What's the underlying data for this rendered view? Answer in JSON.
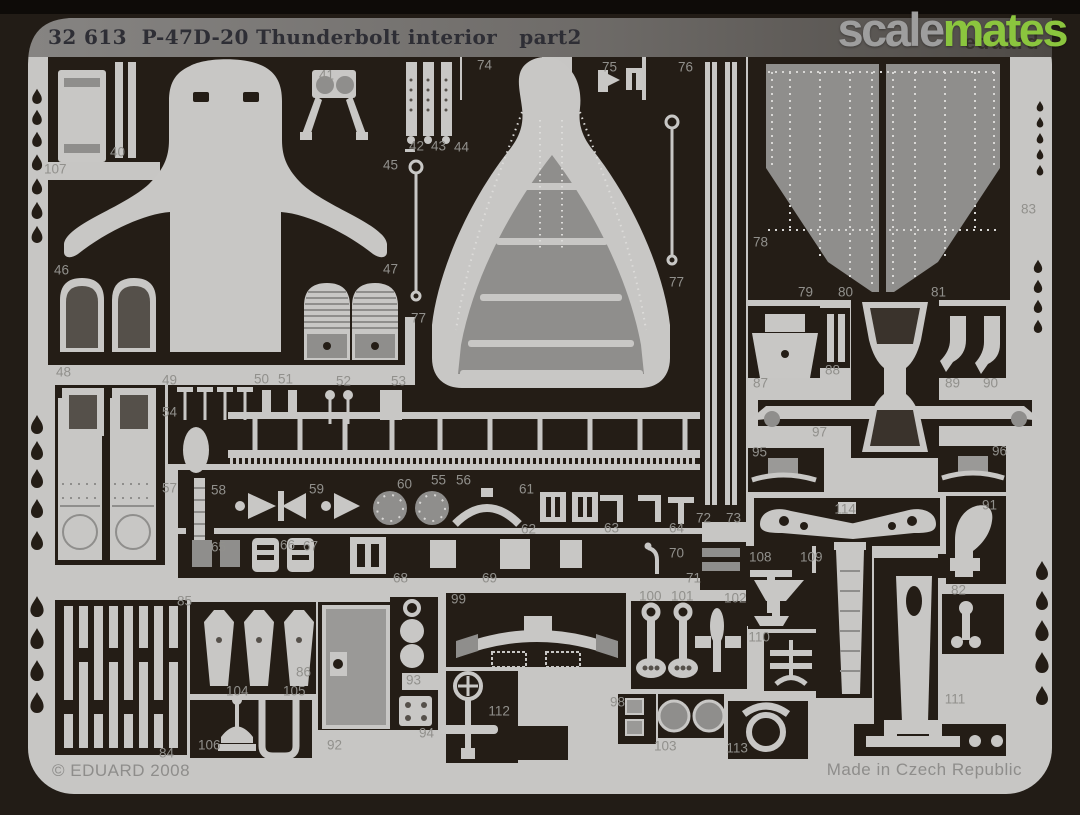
{
  "header": {
    "title": "32 613  P-47D-20 Thunderbolt interior   part2",
    "brand": "eduard"
  },
  "watermark": {
    "scale": "scale",
    "mates": "mates"
  },
  "footer": {
    "copyright": "© EDUARD 2008",
    "made_in": "Made in Czech Republic"
  },
  "colors": {
    "photo_background": "#221c16",
    "fret_metal": "#c7c6c4",
    "cutout_dark": "#241d16",
    "part_medium_gray": "#8f8e8c",
    "label_text": "#91908c",
    "title_text": "#2e2e35",
    "watermark_scale": "#9e9e9e",
    "watermark_mates": "#8bc53e"
  },
  "fret": {
    "description_visible_numbers": "etched part numbers 40 to 114",
    "part_labels": [
      {
        "n": "107",
        "x": 53,
        "y": 169
      },
      {
        "n": "40",
        "x": 116,
        "y": 152
      },
      {
        "n": "41",
        "x": 325,
        "y": 75
      },
      {
        "n": "42",
        "x": 415,
        "y": 146
      },
      {
        "n": "43",
        "x": 437,
        "y": 146
      },
      {
        "n": "44",
        "x": 460,
        "y": 147
      },
      {
        "n": "45",
        "x": 389,
        "y": 165
      },
      {
        "n": "74",
        "x": 483,
        "y": 65
      },
      {
        "n": "75",
        "x": 608,
        "y": 67
      },
      {
        "n": "76",
        "x": 684,
        "y": 67
      },
      {
        "n": "78",
        "x": 759,
        "y": 242
      },
      {
        "n": "83",
        "x": 1027,
        "y": 209
      },
      {
        "n": "79",
        "x": 804,
        "y": 292
      },
      {
        "n": "80",
        "x": 844,
        "y": 292
      },
      {
        "n": "81",
        "x": 937,
        "y": 292
      },
      {
        "n": "46",
        "x": 60,
        "y": 270
      },
      {
        "n": "47",
        "x": 389,
        "y": 269
      },
      {
        "n": "77",
        "x": 417,
        "y": 318
      },
      {
        "n": "77",
        "x": 675,
        "y": 282
      },
      {
        "n": "48",
        "x": 62,
        "y": 372
      },
      {
        "n": "49",
        "x": 168,
        "y": 380
      },
      {
        "n": "50",
        "x": 260,
        "y": 379
      },
      {
        "n": "51",
        "x": 284,
        "y": 379
      },
      {
        "n": "52",
        "x": 342,
        "y": 381
      },
      {
        "n": "53",
        "x": 397,
        "y": 381
      },
      {
        "n": "54",
        "x": 168,
        "y": 412
      },
      {
        "n": "55",
        "x": 437,
        "y": 480
      },
      {
        "n": "56",
        "x": 462,
        "y": 480
      },
      {
        "n": "57",
        "x": 168,
        "y": 488
      },
      {
        "n": "58",
        "x": 217,
        "y": 490
      },
      {
        "n": "59",
        "x": 315,
        "y": 489
      },
      {
        "n": "60",
        "x": 403,
        "y": 484
      },
      {
        "n": "61",
        "x": 525,
        "y": 489
      },
      {
        "n": "62",
        "x": 527,
        "y": 529
      },
      {
        "n": "63",
        "x": 610,
        "y": 528
      },
      {
        "n": "64",
        "x": 675,
        "y": 528
      },
      {
        "n": "65",
        "x": 217,
        "y": 547
      },
      {
        "n": "66",
        "x": 286,
        "y": 545
      },
      {
        "n": "67",
        "x": 309,
        "y": 546
      },
      {
        "n": "68",
        "x": 399,
        "y": 578
      },
      {
        "n": "69",
        "x": 488,
        "y": 578
      },
      {
        "n": "70",
        "x": 675,
        "y": 553
      },
      {
        "n": "71",
        "x": 692,
        "y": 578
      },
      {
        "n": "72",
        "x": 702,
        "y": 518
      },
      {
        "n": "73",
        "x": 732,
        "y": 518
      },
      {
        "n": "87",
        "x": 759,
        "y": 383
      },
      {
        "n": "88",
        "x": 831,
        "y": 370
      },
      {
        "n": "89",
        "x": 951,
        "y": 383
      },
      {
        "n": "90",
        "x": 989,
        "y": 383
      },
      {
        "n": "97",
        "x": 818,
        "y": 432
      },
      {
        "n": "95",
        "x": 758,
        "y": 452
      },
      {
        "n": "96",
        "x": 998,
        "y": 451
      },
      {
        "n": "114",
        "x": 843,
        "y": 509
      },
      {
        "n": "91",
        "x": 988,
        "y": 505
      },
      {
        "n": "108",
        "x": 758,
        "y": 557
      },
      {
        "n": "109",
        "x": 809,
        "y": 557
      },
      {
        "n": "82",
        "x": 957,
        "y": 590
      },
      {
        "n": "85",
        "x": 183,
        "y": 601
      },
      {
        "n": "86",
        "x": 302,
        "y": 672
      },
      {
        "n": "104",
        "x": 235,
        "y": 691
      },
      {
        "n": "105",
        "x": 292,
        "y": 691
      },
      {
        "n": "106",
        "x": 207,
        "y": 745
      },
      {
        "n": "84",
        "x": 165,
        "y": 753
      },
      {
        "n": "92",
        "x": 333,
        "y": 745
      },
      {
        "n": "93",
        "x": 412,
        "y": 680
      },
      {
        "n": "94",
        "x": 425,
        "y": 733
      },
      {
        "n": "99",
        "x": 457,
        "y": 599
      },
      {
        "n": "112",
        "x": 497,
        "y": 711
      },
      {
        "n": "100",
        "x": 648,
        "y": 596
      },
      {
        "n": "101",
        "x": 680,
        "y": 596
      },
      {
        "n": "102",
        "x": 733,
        "y": 598
      },
      {
        "n": "110",
        "x": 757,
        "y": 637
      },
      {
        "n": "98",
        "x": 616,
        "y": 702
      },
      {
        "n": "103",
        "x": 663,
        "y": 746
      },
      {
        "n": "113",
        "x": 735,
        "y": 748
      },
      {
        "n": "111",
        "x": 953,
        "y": 699
      }
    ]
  }
}
